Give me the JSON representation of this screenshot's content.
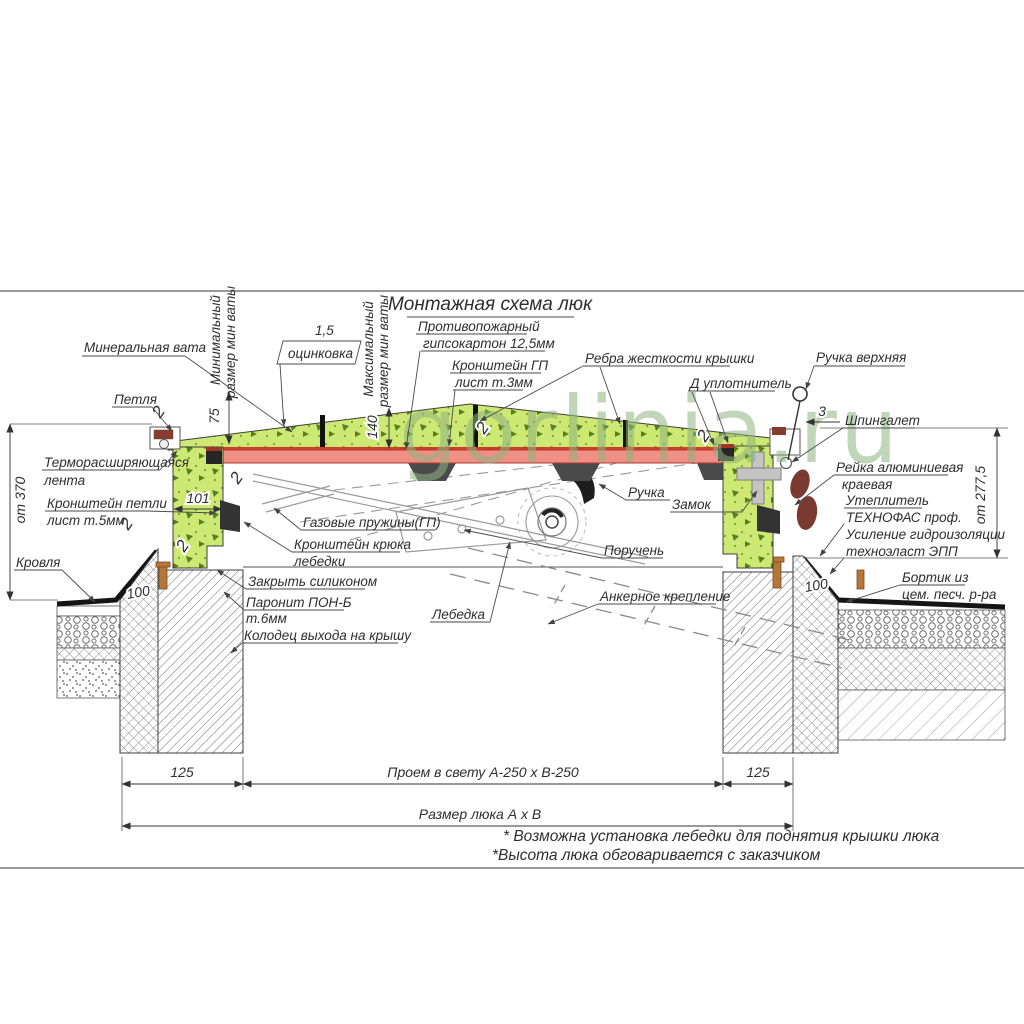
{
  "watermark": "gorlinia.ru",
  "title": "Монтажная схема люк",
  "labels": {
    "mineral_wool": "Минеральная вата",
    "min_size_1": "Минимальный",
    "min_size_2": "размер мин ваты",
    "zinc_value": "1,5",
    "zinc": "оцинковка",
    "max_size_1": "Максимальный",
    "max_size_2": "размер мин ваты",
    "fireproof_1": "Противопожарный",
    "fireproof_2": "гипсокартон 12,5мм",
    "bracket_gp_1": "Кронштейн ГП",
    "bracket_gp_2": "лист т.3мм",
    "ribs": "Ребра жесткости крышки",
    "seal": "Д уплотнитель",
    "handle_top": "Ручка верхняя",
    "latch": "Шпингалет",
    "hinge": "Петля",
    "thermal_1": "Терморасширяющаяся",
    "thermal_2": "лента",
    "hinge_bracket_1": "Кронштейн петли",
    "hinge_bracket_2": "лист т.5мм",
    "roof": "Кровля",
    "alu_rail_1": "Рейка алюминиевая",
    "alu_rail_2": "краевая",
    "insulation_1": "Утеплитель",
    "insulation_2": "ТЕХНОФАС проф.",
    "waterproof_1": "Усиление гидроизоляции",
    "waterproof_2": "техноэласт ЭПП",
    "curb_1": "Бортик из",
    "curb_2": "цем. песч. р-ра",
    "gas_springs": "Газовые пружины(ГП)",
    "hook_bracket_1": "Кронштейн крюка",
    "hook_bracket_2": "лебедки",
    "silicone": "Закрыть силиконом",
    "paronite_1": "Паронит ПОН-Б",
    "paronite_2": "т.6мм",
    "shaft": "Колодец выхода на крышу",
    "winch": "Лебедка",
    "handle": "Ручка",
    "lock": "Замок",
    "handrail": "Поручень",
    "anchor": "Анкерное крепление"
  },
  "dims": {
    "h370": "от 370",
    "h277": "от 277,5",
    "d75": "75",
    "d140": "140",
    "d101": "101",
    "d100": "100",
    "d125": "125",
    "d3": "3",
    "d2": "2",
    "opening": "Проем в свету А-250 х В-250",
    "hatch_size": "Размер люка А х В"
  },
  "notes": [
    "* Возможна установка лебедки для поднятия крышки люка",
    "*Высота люка обговаривается с заказчиком"
  ],
  "colors": {
    "insulation_green": "#cde873",
    "gypsum_red": "#ef8f86",
    "lever_dark_red": "#7a3a31",
    "watermark_green": "#8fb381"
  }
}
